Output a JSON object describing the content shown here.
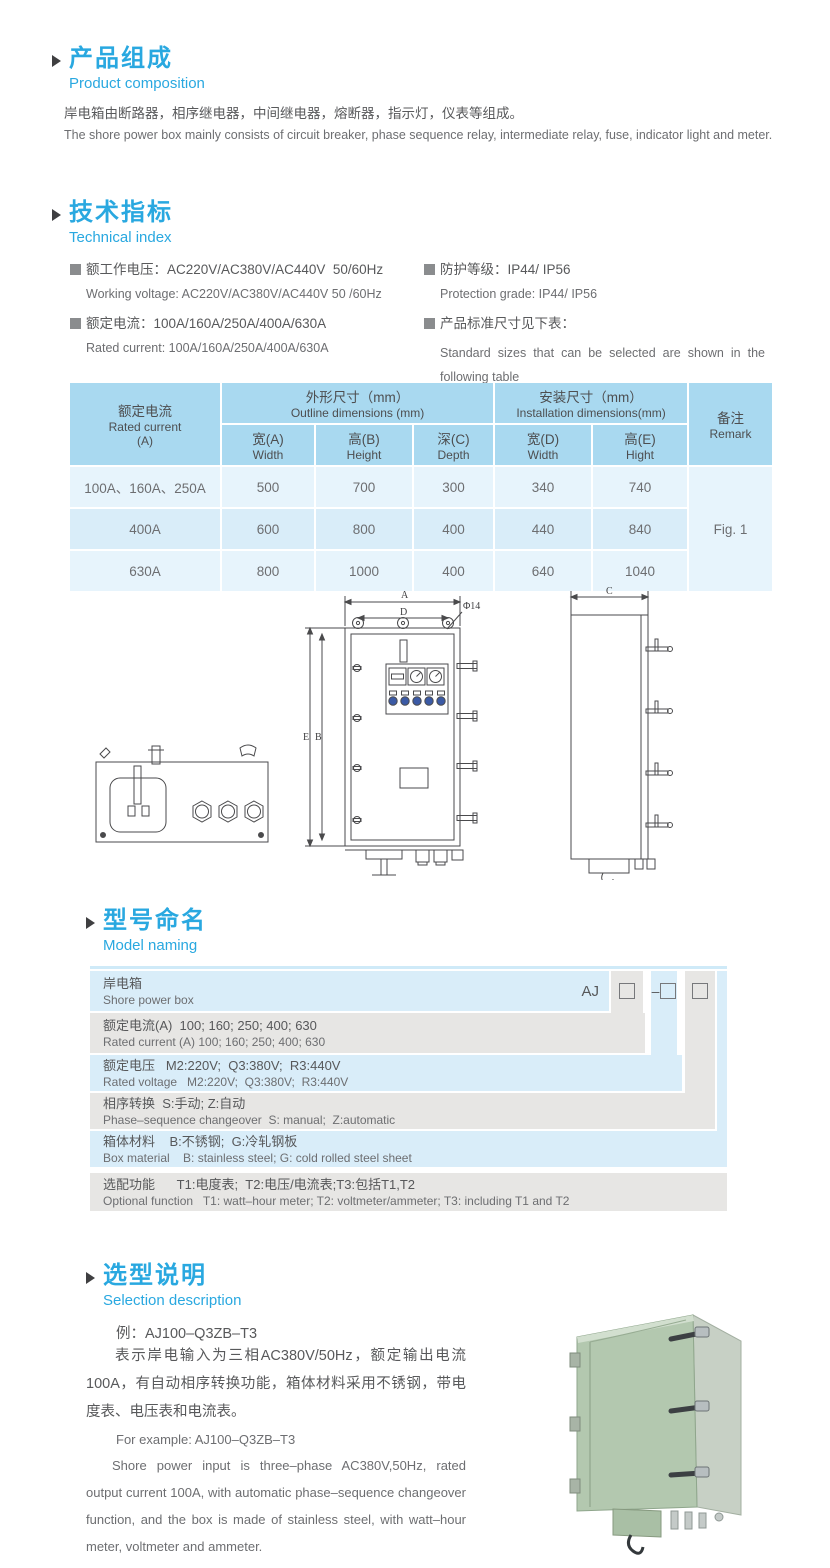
{
  "colors": {
    "accent_blue": "#29a8e0",
    "table_header_blue": "#a9d9f0",
    "table_row_blue": "#e7f4fc",
    "table_row_blue_deep": "#d9edf9",
    "model_row_gray": "#e7e6e4",
    "product_box_green": "#b3c8af"
  },
  "composition": {
    "title_zh": "产品组成",
    "title_en": "Product composition",
    "body_zh": "岸电箱由断路器，相序继电器，中间继电器，熔断器，指示灯，仪表等组成。",
    "body_en": "The shore power box mainly consists of circuit breaker, phase sequence relay, intermediate relay, fuse, indicator light and meter."
  },
  "technical": {
    "title_zh": "技术指标",
    "title_en": "Technical index",
    "left": [
      {
        "zh": "额工作电压：AC220V/AC380V/AC440V  50/60Hz",
        "en": "Working voltage: AC220V/AC380V/AC440V 50 /60Hz"
      },
      {
        "zh": "额定电流：100A/160A/250A/400A/630A",
        "en": "Rated current: 100A/160A/250A/400A/630A"
      }
    ],
    "right": [
      {
        "zh": "防护等级：IP44/ IP56",
        "en": "Protection grade: IP44/ IP56"
      },
      {
        "zh": "产品标准尺寸见下表：",
        "en": "Standard sizes that can be selected are shown in the following table"
      }
    ]
  },
  "dimensions_table": {
    "header": {
      "rated_current_zh": "额定电流",
      "rated_current_en": "Rated current",
      "rated_current_unit": "(A)",
      "outline_zh": "外形尺寸（mm）",
      "outline_en": "Outline dimensions (mm)",
      "install_zh": "安装尺寸（mm）",
      "install_en": "Installation dimensions(mm)",
      "width_a_zh": "宽(A)",
      "width_a_en": "Width",
      "height_b_zh": "高(B)",
      "height_b_en": "Height",
      "depth_c_zh": "深(C)",
      "depth_c_en": "Depth",
      "width_d_zh": "宽(D)",
      "width_d_en": "Width",
      "height_e_zh": "高(E)",
      "height_e_en": "Hight",
      "remark_zh": "备注",
      "remark_en": "Remark"
    },
    "rows": [
      {
        "current": "100A、160A、250A",
        "w": "500",
        "h": "700",
        "d": "300",
        "iw": "340",
        "ih": "740"
      },
      {
        "current": "400A",
        "w": "600",
        "h": "800",
        "d": "400",
        "iw": "440",
        "ih": "840"
      },
      {
        "current": "630A",
        "w": "800",
        "h": "1000",
        "d": "400",
        "iw": "640",
        "ih": "1040"
      }
    ],
    "remark_value": "Fig. 1"
  },
  "drawings": {
    "front": {
      "dim_a": "A",
      "dim_d": "D",
      "dim_phi": "Φ14",
      "dim_e": "E",
      "dim_b": "B"
    },
    "side": {
      "dim_c": "C"
    }
  },
  "model_naming": {
    "title_zh": "型号命名",
    "title_en": "Model naming",
    "code_prefix": "AJ",
    "code_dash": "–",
    "rows": [
      {
        "zh": "岸电箱",
        "en": "Shore power box"
      },
      {
        "zh": "额定电流(A)  100; 160; 250; 400; 630",
        "en": "Rated current (A) 100; 160; 250; 400; 630"
      },
      {
        "zh": "额定电压   M2:220V;  Q3:380V;  R3:440V",
        "en": "Rated voltage   M2:220V;  Q3:380V;  R3:440V"
      },
      {
        "zh": "相序转换  S:手动; Z:自动",
        "en": "Phase–sequence changeover  S: manual;  Z:automatic"
      },
      {
        "zh": "箱体材料    B:不锈钢;  G:冷轧钢板",
        "en": "Box material    B: stainless steel; G: cold rolled steel sheet"
      },
      {
        "zh": "选配功能      T1:电度表;  T2:电压/电流表;T3:包括T1,T2",
        "en": "Optional function   T1: watt–hour meter; T2: voltmeter/ammeter; T3: including T1 and T2"
      }
    ]
  },
  "selection": {
    "title_zh": "选型说明",
    "title_en": "Selection description",
    "example_zh": "例：AJ100–Q3ZB–T3",
    "para_zh": "表示岸电输入为三相AC380V/50Hz，额定输出电流100A，有自动相序转换功能，箱体材料采用不锈钢，带电度表、电压表和电流表。",
    "example_en": "For example: AJ100–Q3ZB–T3",
    "para_en": "Shore power input is three–phase AC380V,50Hz, rated output current 100A, with automatic phase–sequence changeover function, and the box is made of stainless steel, with watt–hour meter, voltmeter and ammeter."
  }
}
